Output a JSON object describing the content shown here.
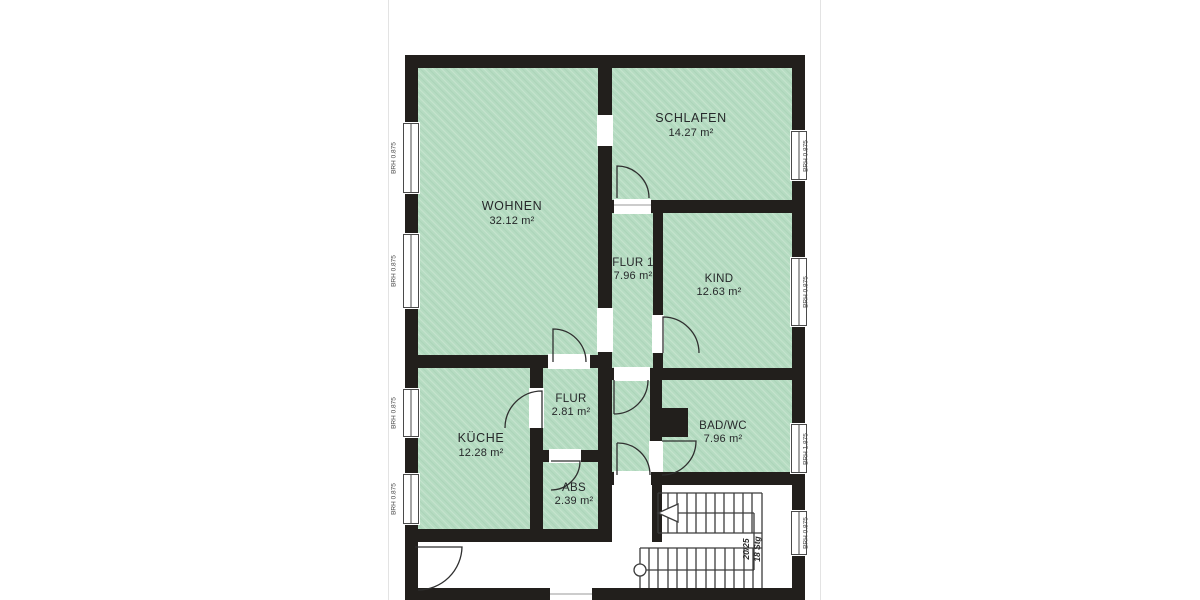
{
  "plan": {
    "rooms": [
      {
        "id": "wohnen",
        "name": "WOHNEN",
        "area": "32.12 m²"
      },
      {
        "id": "schlafen",
        "name": "SCHLAFEN",
        "area": "14.27 m²"
      },
      {
        "id": "flur1",
        "name": "FLUR 1",
        "area": "7.96 m²"
      },
      {
        "id": "kind",
        "name": "KIND",
        "area": "12.63 m²"
      },
      {
        "id": "kueche",
        "name": "KÜCHE",
        "area": "12.28 m²"
      },
      {
        "id": "flur",
        "name": "FLUR",
        "area": "2.81 m²"
      },
      {
        "id": "abs",
        "name": "ABS",
        "area": "2.39 m²"
      },
      {
        "id": "badwc",
        "name": "BAD/WC",
        "area": "7.96 m²"
      }
    ],
    "window_labels": {
      "left": [
        "BRH 0.875",
        "BRH 0.875",
        "BRH 0.875",
        "BRH 0.875"
      ],
      "right": [
        "BRH 0.875",
        "BRH 0.875",
        "BRH 1.875",
        "BRH 0.875"
      ]
    },
    "staircase": {
      "rise_run_label": "20/25",
      "steps_label": "18 Stg"
    },
    "colors": {
      "room_fill": "#b6dcc2",
      "wall": "#221f1c",
      "paper": "#ffffff"
    }
  }
}
